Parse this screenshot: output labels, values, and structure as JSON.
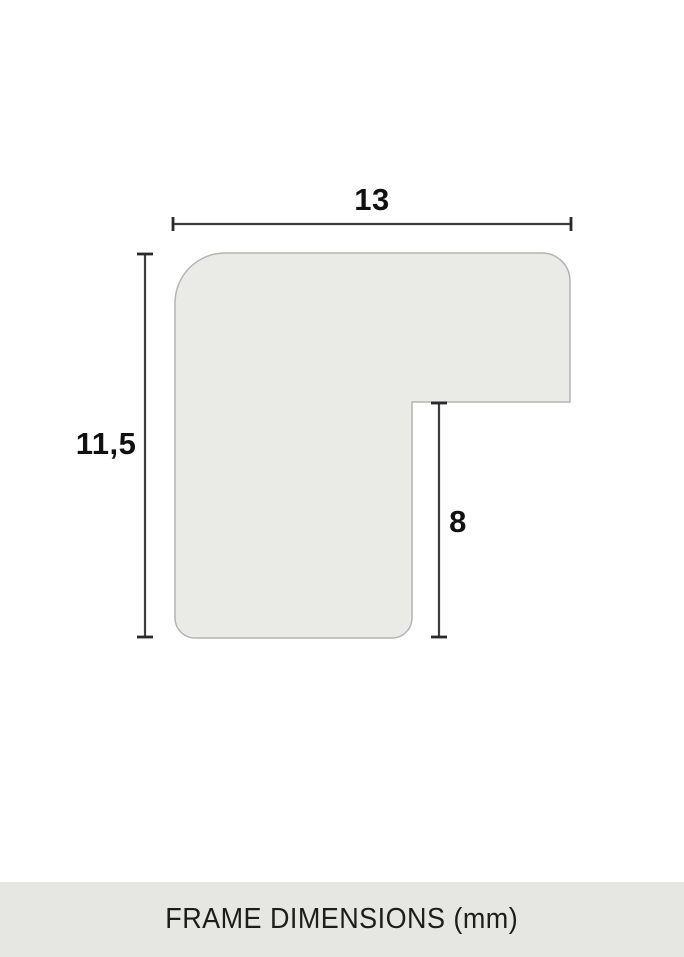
{
  "diagram": {
    "caption": "FRAME DIMENSIONS (mm)",
    "dimensions": {
      "width": {
        "label": "13"
      },
      "height": {
        "label": "11,5"
      },
      "depth": {
        "label": "8"
      }
    }
  },
  "colors": {
    "page-bg": "#ffffff",
    "profile-fill": "#eaeae7",
    "profile-stroke": "#b4b4b1",
    "dim-line": "#3c3c3c",
    "dim-tick": "#2a2a2a",
    "label-color": "#111111",
    "footer-bg": "#e6e6e2",
    "footer-text": "#1d1d1b"
  }
}
